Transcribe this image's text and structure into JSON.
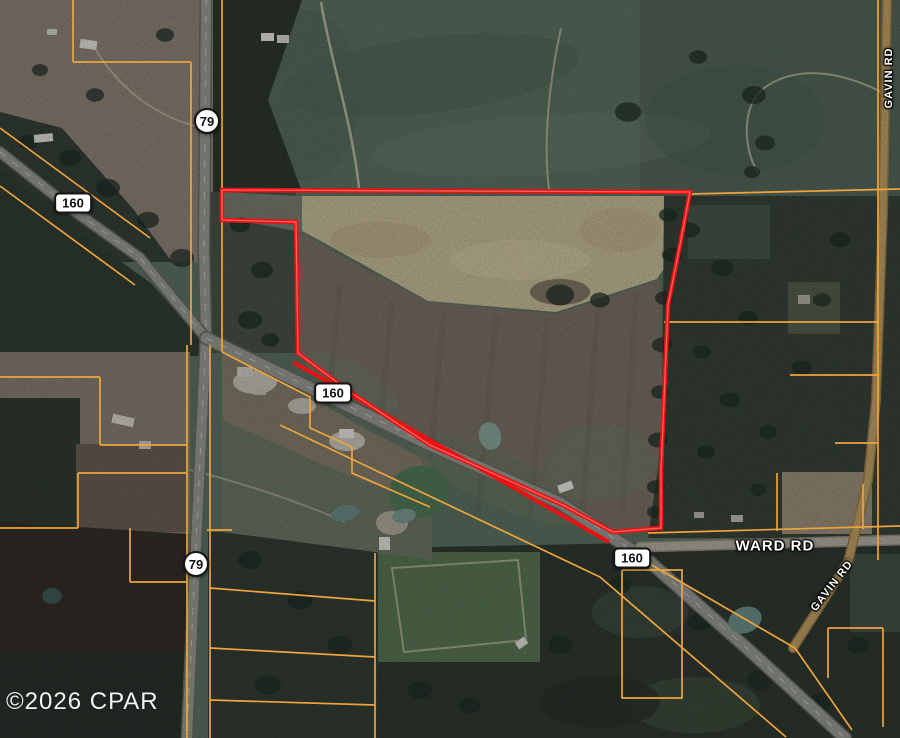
{
  "map": {
    "type": "satellite-parcel-map",
    "colors": {
      "parcel_line": "#eea43c",
      "boundary": "#e91212",
      "boundary_highlight": "#ff7070",
      "road_paved": "#9b9d96",
      "road_paved_casing": "#6a6d66",
      "road_light": "#b6b2a6",
      "road_light_casing": "#968f80",
      "road_dirt": "#c6a468",
      "road_dirt_casing": "#a07f48",
      "centerline": "#d8d8d0",
      "label_text": "#ffffff",
      "shield_bg": "#ffffff",
      "shield_border": "#141414"
    },
    "shields": [
      {
        "id": "hwy-79-north",
        "label": "79",
        "shape": "circle",
        "x": 207,
        "y": 121
      },
      {
        "id": "hwy-79-south",
        "label": "79",
        "shape": "circle",
        "x": 196,
        "y": 564
      },
      {
        "id": "hwy-160-west",
        "label": "160",
        "shape": "rect",
        "x": 73,
        "y": 203
      },
      {
        "id": "hwy-160-mid",
        "label": "160",
        "shape": "rect",
        "x": 333,
        "y": 393
      },
      {
        "id": "hwy-160-east",
        "label": "160",
        "shape": "rect",
        "x": 632,
        "y": 558
      }
    ],
    "road_labels": [
      {
        "id": "gavin-rd-north",
        "text": "GAVIN RD",
        "x": 889,
        "y": 78,
        "rotation": -90,
        "size": 11
      },
      {
        "id": "gavin-rd-south",
        "text": "GAVIN RD",
        "x": 832,
        "y": 586,
        "rotation": -52,
        "size": 11
      },
      {
        "id": "ward-rd",
        "text": "WARD RD",
        "x": 775,
        "y": 546,
        "rotation": 0,
        "size": 15
      }
    ],
    "roads": [
      {
        "name": "highway-79",
        "surface": "paved",
        "width": 10,
        "dashed": true,
        "points": [
          [
            206,
            0
          ],
          [
            204,
            250
          ],
          [
            206,
            335
          ],
          [
            195,
            565
          ],
          [
            187,
            738
          ]
        ]
      },
      {
        "name": "highway-160-west",
        "surface": "paved",
        "width": 9,
        "dashed": true,
        "points": [
          [
            0,
            152
          ],
          [
            73,
            210
          ],
          [
            140,
            258
          ],
          [
            206,
            338
          ]
        ]
      },
      {
        "name": "highway-160-east",
        "surface": "paved",
        "width": 11,
        "dashed": true,
        "points": [
          [
            206,
            338
          ],
          [
            430,
            445
          ],
          [
            560,
            503
          ],
          [
            650,
            562
          ],
          [
            760,
            660
          ],
          [
            845,
            738
          ]
        ]
      },
      {
        "name": "ward-rd",
        "surface": "light",
        "width": 8,
        "dashed": false,
        "points": [
          [
            640,
            547
          ],
          [
            900,
            540
          ]
        ]
      },
      {
        "name": "gavin-rd-north",
        "surface": "dirt",
        "width": 7,
        "dashed": false,
        "points": [
          [
            887,
            0
          ],
          [
            883,
            210
          ],
          [
            876,
            400
          ],
          [
            868,
            480
          ],
          [
            848,
            562
          ]
        ]
      },
      {
        "name": "gavin-rd-south",
        "surface": "dirt",
        "width": 7,
        "dashed": false,
        "points": [
          [
            848,
            562
          ],
          [
            793,
            648
          ]
        ]
      }
    ],
    "parcel_lines": [
      [
        [
          73,
          0
        ],
        [
          73,
          62
        ]
      ],
      [
        [
          73,
          62
        ],
        [
          191,
          62
        ]
      ],
      [
        [
          191,
          62
        ],
        [
          191,
          345
        ]
      ],
      [
        [
          222,
          0
        ],
        [
          222,
          352
        ]
      ],
      [
        [
          0,
          128
        ],
        [
          150,
          238
        ]
      ],
      [
        [
          0,
          186
        ],
        [
          135,
          285
        ]
      ],
      [
        [
          690,
          194
        ],
        [
          900,
          189
        ]
      ],
      [
        [
          878,
          0
        ],
        [
          878,
          560
        ]
      ],
      [
        [
          664,
          322
        ],
        [
          878,
          322
        ]
      ],
      [
        [
          790,
          375
        ],
        [
          878,
          375
        ]
      ],
      [
        [
          835,
          443
        ],
        [
          878,
          443
        ]
      ],
      [
        [
          648,
          533
        ],
        [
          900,
          526
        ]
      ],
      [
        [
          777,
          473
        ],
        [
          777,
          531
        ]
      ],
      [
        [
          863,
          484
        ],
        [
          863,
          529
        ]
      ],
      [
        [
          0,
          377
        ],
        [
          100,
          377
        ]
      ],
      [
        [
          100,
          377
        ],
        [
          100,
          445
        ]
      ],
      [
        [
          100,
          445
        ],
        [
          187,
          445
        ]
      ],
      [
        [
          78,
          473
        ],
        [
          187,
          473
        ]
      ],
      [
        [
          78,
          473
        ],
        [
          78,
          528
        ]
      ],
      [
        [
          0,
          528
        ],
        [
          78,
          528
        ]
      ],
      [
        [
          130,
          528
        ],
        [
          130,
          582
        ]
      ],
      [
        [
          130,
          582
        ],
        [
          187,
          582
        ]
      ],
      [
        [
          187,
          345
        ],
        [
          187,
          738
        ]
      ],
      [
        [
          210,
          345
        ],
        [
          210,
          738
        ]
      ],
      [
        [
          207,
          530
        ],
        [
          232,
          530
        ]
      ],
      [
        [
          222,
          352
        ],
        [
          310,
          397
        ],
        [
          310,
          428
        ],
        [
          352,
          447
        ],
        [
          352,
          473
        ],
        [
          430,
          507
        ]
      ],
      [
        [
          280,
          425
        ],
        [
          600,
          577
        ],
        [
          786,
          737
        ]
      ],
      [
        [
          643,
          560
        ],
        [
          795,
          648
        ],
        [
          852,
          730
        ]
      ],
      [
        [
          622,
          570
        ],
        [
          682,
          570
        ],
        [
          682,
          698
        ],
        [
          622,
          698
        ],
        [
          622,
          570
        ]
      ],
      [
        [
          828,
          628
        ],
        [
          883,
          628
        ]
      ],
      [
        [
          828,
          628
        ],
        [
          828,
          678
        ]
      ],
      [
        [
          883,
          628
        ],
        [
          883,
          727
        ]
      ],
      [
        [
          210,
          588
        ],
        [
          375,
          601
        ]
      ],
      [
        [
          210,
          648
        ],
        [
          375,
          657
        ]
      ],
      [
        [
          210,
          700
        ],
        [
          375,
          705
        ]
      ],
      [
        [
          375,
          553
        ],
        [
          375,
          738
        ]
      ]
    ],
    "boundary": {
      "width": 4.5,
      "points": [
        [
          222,
          190
        ],
        [
          690,
          192
        ],
        [
          680,
          245
        ],
        [
          668,
          305
        ],
        [
          664,
          400
        ],
        [
          661,
          470
        ],
        [
          661,
          528
        ],
        [
          613,
          532
        ],
        [
          563,
          505
        ],
        [
          430,
          445
        ],
        [
          350,
          392
        ],
        [
          298,
          353
        ],
        [
          296,
          222
        ],
        [
          222,
          220
        ]
      ],
      "inner_segment": [
        [
          293,
          362
        ],
        [
          609,
          542
        ]
      ]
    },
    "ponds": [
      {
        "cx": 490,
        "cy": 436,
        "rx": 11,
        "ry": 14,
        "rot": -15,
        "color": "#8fa9a0"
      },
      {
        "cx": 419,
        "cy": 492,
        "rx": 30,
        "ry": 26,
        "rot": -8,
        "color": "#537d5b"
      },
      {
        "cx": 404,
        "cy": 516,
        "rx": 12,
        "ry": 7,
        "rot": -10,
        "color": "#7f9e98"
      },
      {
        "cx": 345,
        "cy": 513,
        "rx": 14,
        "ry": 8,
        "rot": -12,
        "color": "#6f908a"
      },
      {
        "cx": 745,
        "cy": 620,
        "rx": 17,
        "ry": 13,
        "rot": -20,
        "color": "#6e938c"
      },
      {
        "cx": 52,
        "cy": 596,
        "rx": 10,
        "ry": 8,
        "rot": 0,
        "color": "#415c57"
      }
    ],
    "buildings": [
      {
        "x": 80,
        "y": 40,
        "w": 17,
        "h": 9,
        "rot": 8,
        "color": "#e9e7e1"
      },
      {
        "x": 47,
        "y": 29,
        "w": 10,
        "h": 6,
        "rot": 0,
        "color": "#d9d6ce"
      },
      {
        "x": 261,
        "y": 33,
        "w": 13,
        "h": 8,
        "rot": 0,
        "color": "#edebe5"
      },
      {
        "x": 277,
        "y": 35,
        "w": 12,
        "h": 8,
        "rot": 0,
        "color": "#dedcd4"
      },
      {
        "x": 34,
        "y": 134,
        "w": 19,
        "h": 8,
        "rot": -5,
        "color": "#e5e3db"
      },
      {
        "x": 112,
        "y": 416,
        "w": 22,
        "h": 9,
        "rot": 12,
        "color": "#ddd9d0"
      },
      {
        "x": 139,
        "y": 441,
        "w": 12,
        "h": 8,
        "rot": 0,
        "color": "#d0cdc5"
      },
      {
        "x": 237,
        "y": 367,
        "w": 16,
        "h": 10,
        "rot": 0,
        "color": "#d7d4cb"
      },
      {
        "x": 254,
        "y": 387,
        "w": 12,
        "h": 8,
        "rot": 0,
        "color": "#c9c6be"
      },
      {
        "x": 339,
        "y": 429,
        "w": 15,
        "h": 9,
        "rot": 0,
        "color": "#f0ede7"
      },
      {
        "x": 379,
        "y": 537,
        "w": 11,
        "h": 13,
        "rot": 0,
        "color": "#e9e7e0"
      },
      {
        "x": 558,
        "y": 483,
        "w": 15,
        "h": 8,
        "rot": -20,
        "color": "#f0eee8"
      },
      {
        "x": 516,
        "y": 639,
        "w": 11,
        "h": 8,
        "rot": -35,
        "color": "#e7e5de"
      },
      {
        "x": 798,
        "y": 295,
        "w": 12,
        "h": 9,
        "rot": 0,
        "color": "#bab5ab"
      },
      {
        "x": 731,
        "y": 515,
        "w": 12,
        "h": 7,
        "rot": 0,
        "color": "#c5c1b7"
      },
      {
        "x": 694,
        "y": 512,
        "w": 10,
        "h": 6,
        "rot": 0,
        "color": "#bebab0"
      }
    ],
    "tree_clusters": [
      [
        628,
        112,
        13
      ],
      [
        698,
        57,
        9
      ],
      [
        754,
        95,
        12
      ],
      [
        765,
        143,
        10
      ],
      [
        752,
        172,
        8
      ],
      [
        668,
        215,
        9
      ],
      [
        672,
        255,
        10
      ],
      [
        664,
        298,
        9
      ],
      [
        662,
        345,
        10
      ],
      [
        660,
        392,
        9
      ],
      [
        658,
        440,
        10
      ],
      [
        656,
        487,
        9
      ],
      [
        655,
        512,
        8
      ],
      [
        28,
        142,
        10
      ],
      [
        70,
        158,
        11
      ],
      [
        108,
        188,
        12
      ],
      [
        148,
        220,
        11
      ],
      [
        182,
        258,
        12
      ],
      [
        240,
        225,
        10
      ],
      [
        262,
        270,
        11
      ],
      [
        250,
        320,
        12
      ],
      [
        270,
        340,
        9
      ],
      [
        560,
        295,
        14
      ],
      [
        600,
        300,
        10
      ],
      [
        250,
        560,
        12
      ],
      [
        300,
        600,
        13
      ],
      [
        340,
        645,
        12
      ],
      [
        268,
        685,
        13
      ],
      [
        420,
        690,
        12
      ],
      [
        470,
        705,
        11
      ],
      [
        560,
        645,
        12
      ],
      [
        620,
        585,
        11
      ],
      [
        700,
        622,
        12
      ],
      [
        760,
        680,
        13
      ],
      [
        820,
        702,
        12
      ],
      [
        858,
        645,
        11
      ],
      [
        690,
        230,
        10
      ],
      [
        722,
        268,
        11
      ],
      [
        748,
        318,
        10
      ],
      [
        702,
        352,
        9
      ],
      [
        730,
        400,
        10
      ],
      [
        768,
        432,
        9
      ],
      [
        802,
        368,
        10
      ],
      [
        822,
        300,
        9
      ],
      [
        840,
        240,
        10
      ],
      [
        706,
        452,
        9
      ],
      [
        758,
        490,
        8
      ],
      [
        95,
        95,
        9
      ],
      [
        40,
        70,
        8
      ],
      [
        165,
        35,
        9
      ]
    ]
  },
  "watermark": {
    "text": "©2026 CPAR"
  }
}
